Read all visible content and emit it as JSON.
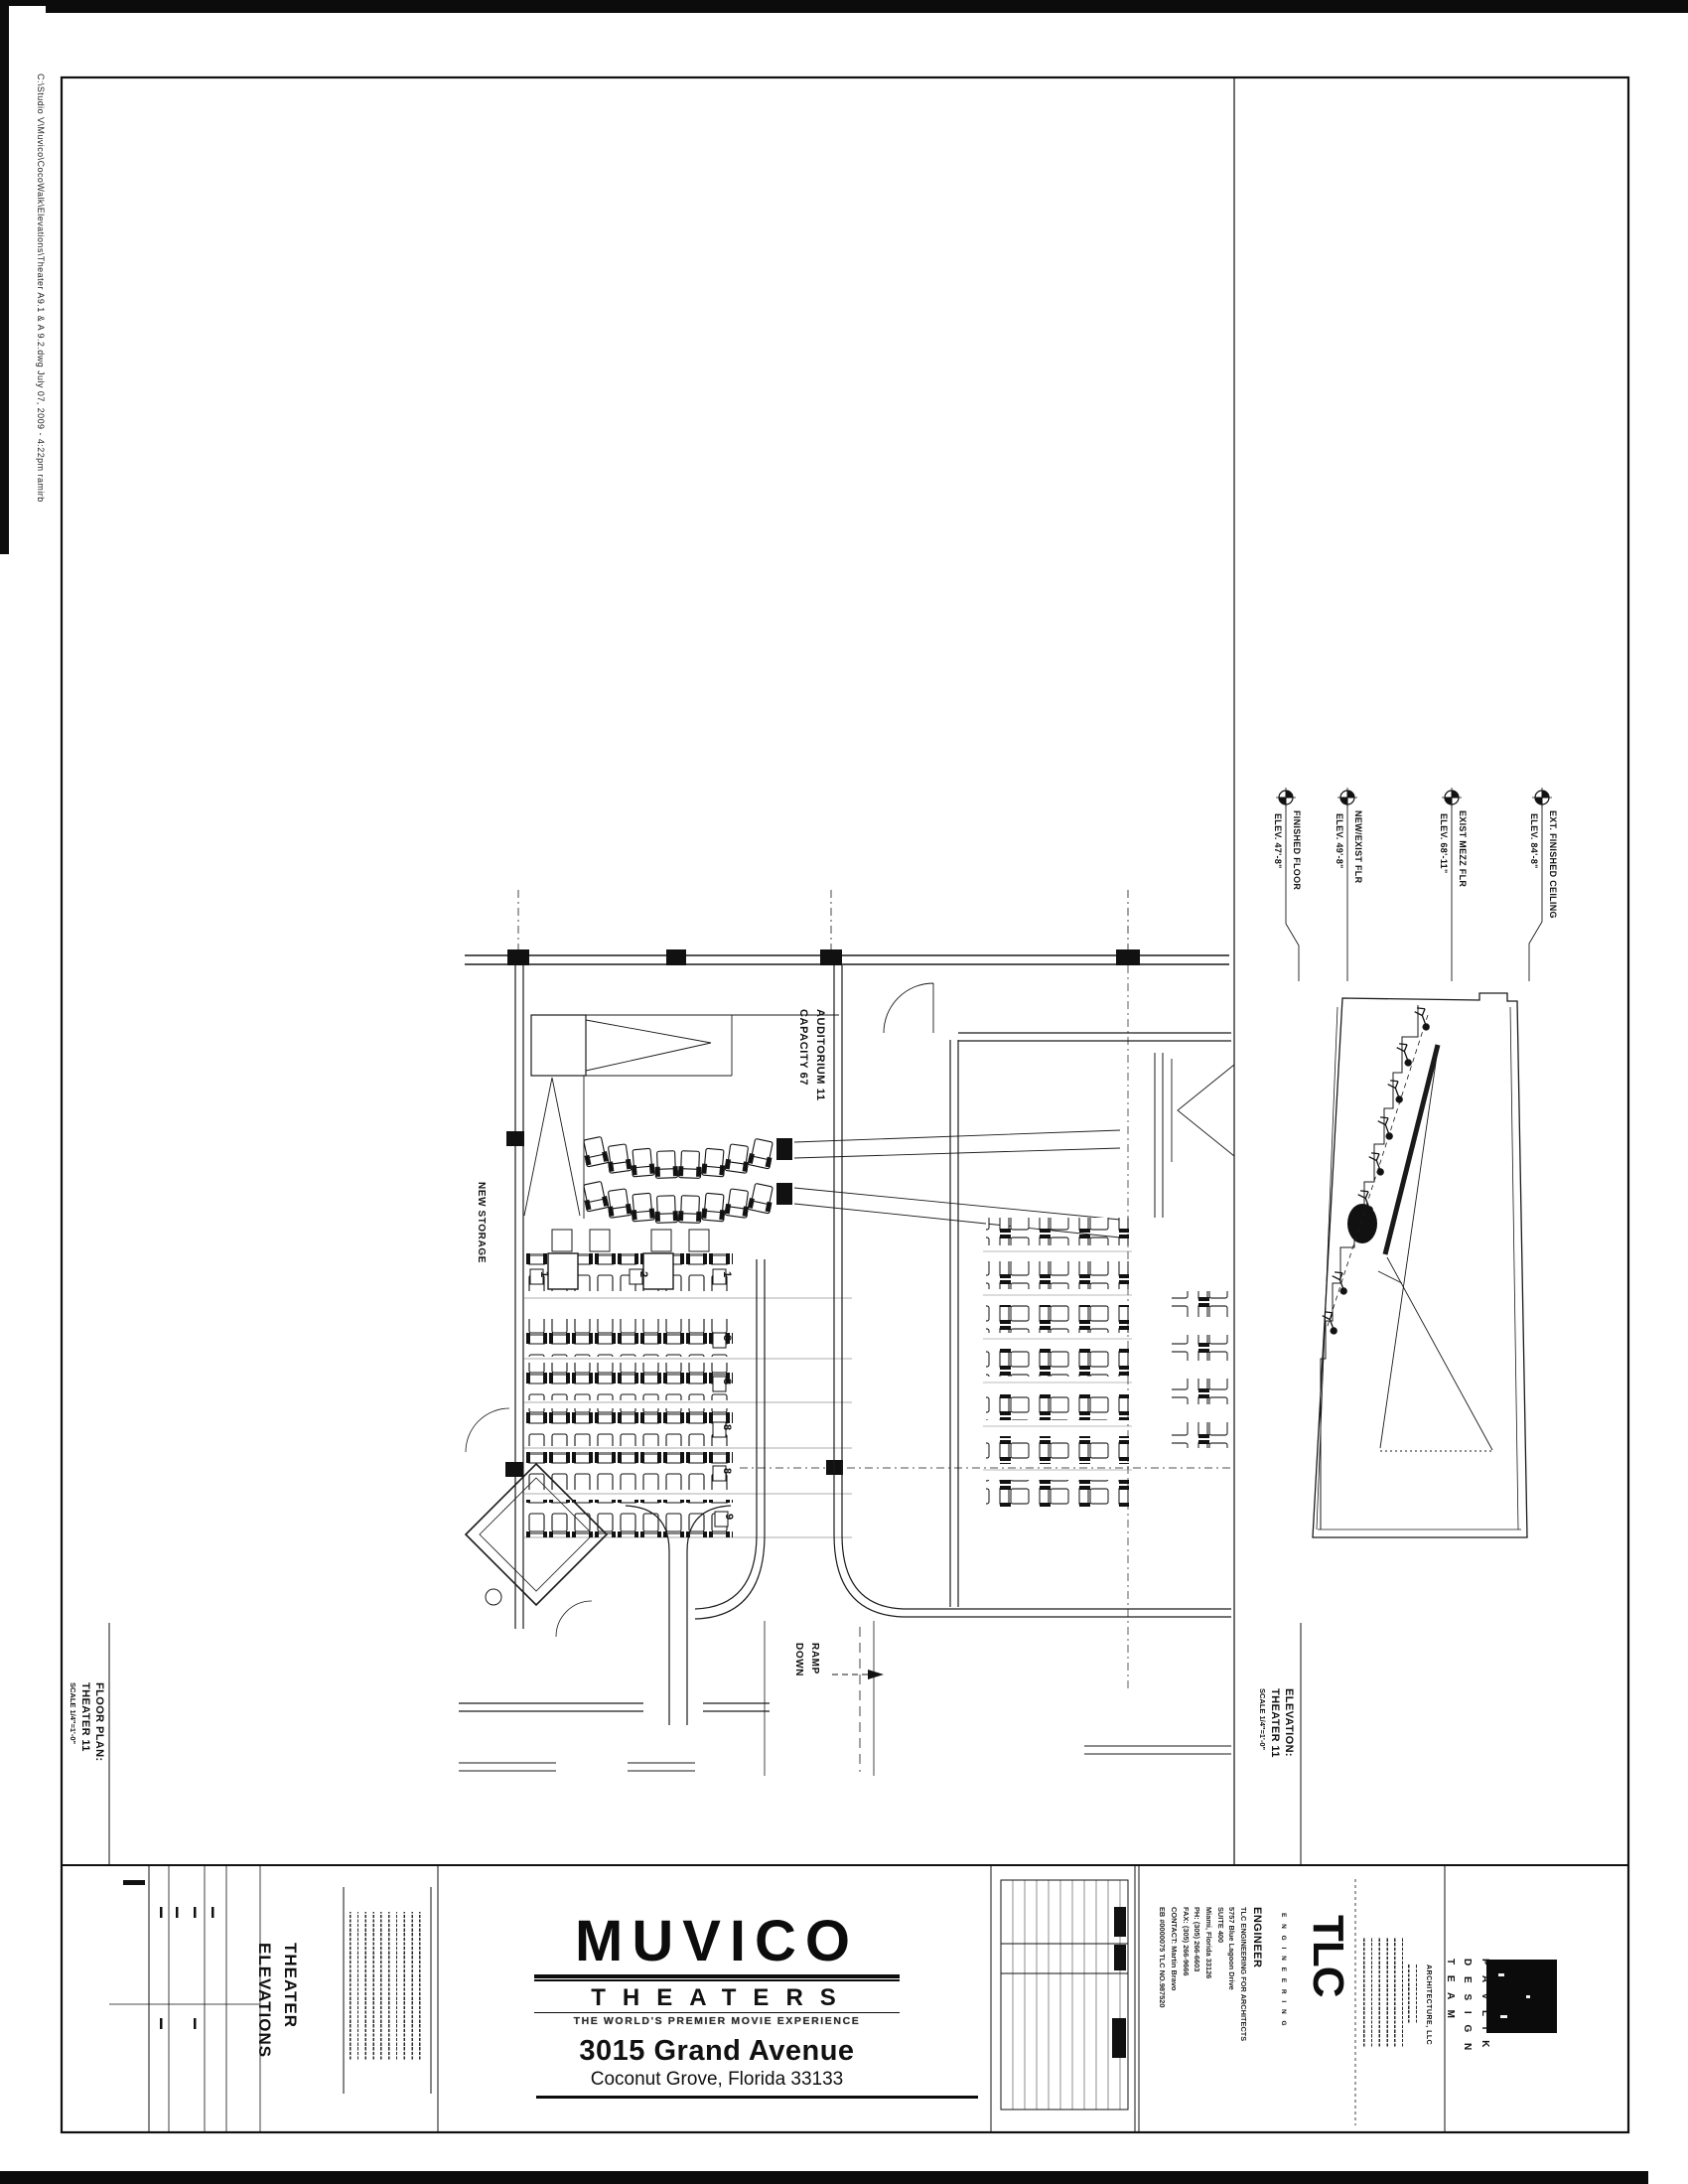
{
  "sheet": {
    "margin_note": "C:\\Studio V\\Muvico\\CocoWalk\\Elevations\\Theater A9.1 & A 9.2.dwg    July 07, 2009 - 4:22pm  ramirb"
  },
  "plan": {
    "label_new_storage": "NEW STORAGE",
    "label_auditorium_line1": "AUDITORIUM 11",
    "label_auditorium_line2": "CAPACITY 67",
    "label_ramp_line1": "RAMP",
    "label_ramp_line2": "DOWN",
    "row_badges": [
      "1",
      "2",
      "1",
      "8",
      "8",
      "8",
      "8",
      "9"
    ],
    "title_line1": "FLOOR PLAN:",
    "title_line2": "THEATER 11",
    "title_line3": "SCALE 1/4\"=1'-0\""
  },
  "elevation": {
    "title_line1": "ELEVATION:",
    "title_line2": "THEATER 11",
    "title_line3": "SCALE 1/4\"=1'-0\"",
    "markers": [
      {
        "label": "FINISHED FLOOR",
        "elev": "ELEV. 47'-8\""
      },
      {
        "label": "NEW/EXIST FLR",
        "elev": "ELEV. 49'-8\""
      },
      {
        "label": "EXIST MEZZ FLR",
        "elev": "ELEV. 68'-11\""
      },
      {
        "label": "EXT. FINISHED CEILING",
        "elev": "ELEV. 84'-8\""
      }
    ]
  },
  "title_block": {
    "sheet_title_line1": "THEATER",
    "sheet_title_line2": "ELEVATIONS",
    "brand": {
      "logo": "MUVICO",
      "word": "THEATERS",
      "tagline": "THE WORLD'S PREMIER MOVIE EXPERIENCE",
      "address_line1": "3015 Grand Avenue",
      "address_line2": "Coconut Grove, Florida 33133"
    },
    "engineer": {
      "heading": "ENGINEER",
      "lines": [
        "TLC ENGINEERING FOR ARCHITECTS",
        "5757 Blue Lagoon Drive",
        "SUITE 400",
        "Miami, Florida 33126",
        "PH: (305) 266-6603",
        "FAX: (305) 266-9666",
        "CONTACT: Martin Bravo",
        "EB #0000075      TLC NO.987520"
      ],
      "logo_text": "TLC",
      "logo_caption": "E N G I N E E R I N G"
    },
    "architect": {
      "firm": "ARCHITECTURE, LLC",
      "design_line1": "P A V L I K",
      "design_line2": "D E S I G N",
      "design_line3": "T E A M"
    }
  }
}
